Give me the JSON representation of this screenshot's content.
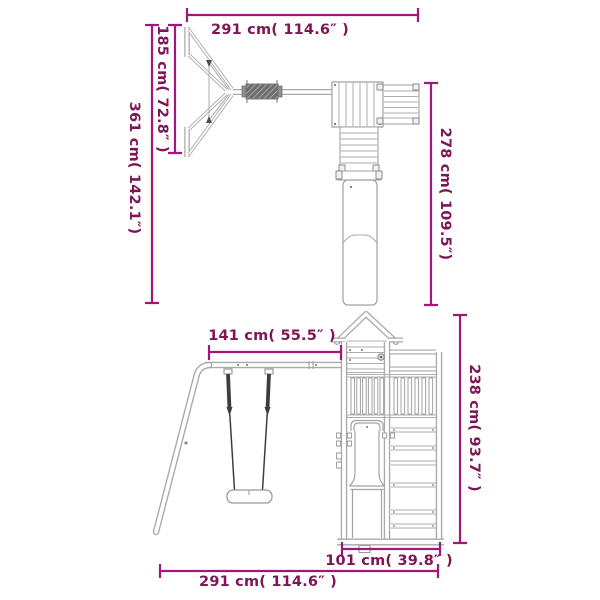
{
  "diagram": {
    "colors": {
      "dimension_line": "#a2177c",
      "dimension_text": "#7d1556",
      "structure_outline": "#a9a9a9",
      "rope_dark": "#3d3d3d"
    },
    "top_view": {
      "overall_width_label": "291 cm( 114.6″ )",
      "swing_frame_depth_label": "185 cm( 72.8″ )",
      "overall_depth_label": "361 cm( 142.1″)",
      "tower_section_depth_label": "278 cm( 109.5″)"
    },
    "front_view": {
      "swing_section_width_label": "141 cm( 55.5″ )",
      "overall_height_label": "238 cm( 93.7″ )",
      "tower_section_width_label": "101 cm( 39.8″ )",
      "overall_width_label": "291 cm( 114.6″ )"
    }
  }
}
